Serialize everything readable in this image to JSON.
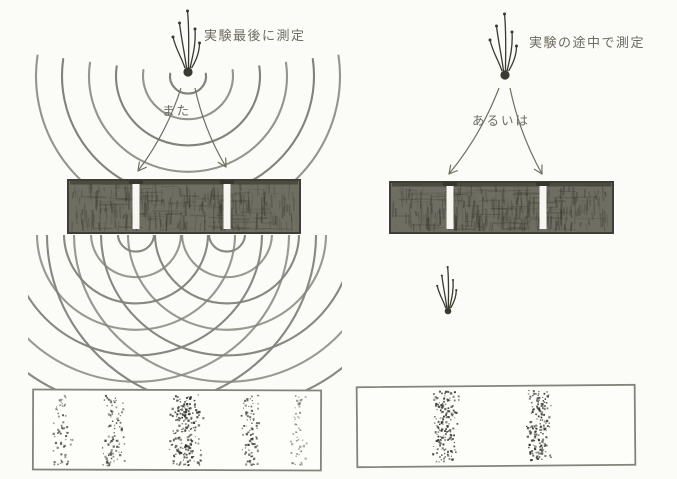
{
  "colors": {
    "paper": "#fbfbf7",
    "ink": "#6f6f64",
    "arc": "#82827a",
    "barrier_fill": "#6e6e62",
    "barrier_stroke": "#2e2e28",
    "barrier_edge": "#3e3e36",
    "slit_fill": "#f7f7f2",
    "screen_fill": "#fdfdfa",
    "screen_edge": "#84847c",
    "dot": "#32322c",
    "source": "#3a3a32"
  },
  "left_panel": {
    "caption": "実験最後に測定",
    "caption_pos": {
      "x": 204,
      "y": 25
    },
    "connector_label": "また",
    "connector_pos": {
      "x": 162,
      "y": 100
    },
    "source": {
      "x": 188,
      "y": 72,
      "scale": 1
    },
    "waves": {
      "cx": 188,
      "cy": 76,
      "radii": [
        18,
        45,
        72,
        99,
        126,
        152
      ]
    },
    "arrows": [
      {
        "x1": 181,
        "y1": 88,
        "x2": 138,
        "y2": 171,
        "bow": 8
      },
      {
        "x1": 195,
        "y1": 88,
        "x2": 226,
        "y2": 167,
        "bow": -7
      }
    ],
    "barrier": {
      "x": 68,
      "y": 180,
      "w": 232,
      "h": 53,
      "slits": [
        {
          "cx": 136,
          "w": 7
        },
        {
          "cx": 227,
          "w": 7
        }
      ]
    },
    "interference": {
      "centers": [
        {
          "x": 136,
          "y": 234
        },
        {
          "x": 227,
          "y": 234
        }
      ],
      "radii": [
        18,
        45,
        72,
        99,
        126,
        153,
        180
      ],
      "clip": {
        "x": 28,
        "y": 235,
        "w": 314,
        "h": 155
      }
    },
    "screen": {
      "x": 33,
      "y": 390,
      "w": 288,
      "h": 80,
      "rot": 0.2
    },
    "bands": [
      {
        "cx": 61,
        "hw": 7,
        "n": 62,
        "o": 0.75
      },
      {
        "cx": 113,
        "hw": 8,
        "n": 88,
        "o": 0.85
      },
      {
        "cx": 185,
        "hw": 12,
        "n": 190,
        "o": 0.95
      },
      {
        "cx": 250,
        "hw": 8,
        "n": 88,
        "o": 0.85
      },
      {
        "cx": 297,
        "hw": 6,
        "n": 48,
        "o": 0.55
      }
    ]
  },
  "right_panel": {
    "caption": "実験の途中で測定",
    "caption_pos": {
      "x": 529,
      "y": 32
    },
    "connector_label": "あるいは",
    "connector_pos": {
      "x": 472,
      "y": 110
    },
    "source": {
      "x": 505,
      "y": 75,
      "scale": 1
    },
    "arrows": [
      {
        "x1": 499,
        "y1": 88,
        "x2": 449,
        "y2": 174,
        "bow": 8
      },
      {
        "x1": 510,
        "y1": 88,
        "x2": 542,
        "y2": 174,
        "bow": -7
      }
    ],
    "barrier": {
      "x": 390,
      "y": 182,
      "w": 223,
      "h": 51,
      "slits": [
        {
          "cx": 450,
          "w": 7
        },
        {
          "cx": 543,
          "w": 7
        }
      ]
    },
    "particle": {
      "x": 448,
      "y": 311,
      "scale": 0.72
    },
    "screen": {
      "x": 357,
      "y": 386,
      "w": 278,
      "h": 80,
      "rot": -0.5
    },
    "bands": [
      {
        "cx": 445,
        "hw": 9,
        "n": 165,
        "o": 0.95
      },
      {
        "cx": 538,
        "hw": 9,
        "n": 165,
        "o": 0.95
      }
    ]
  }
}
